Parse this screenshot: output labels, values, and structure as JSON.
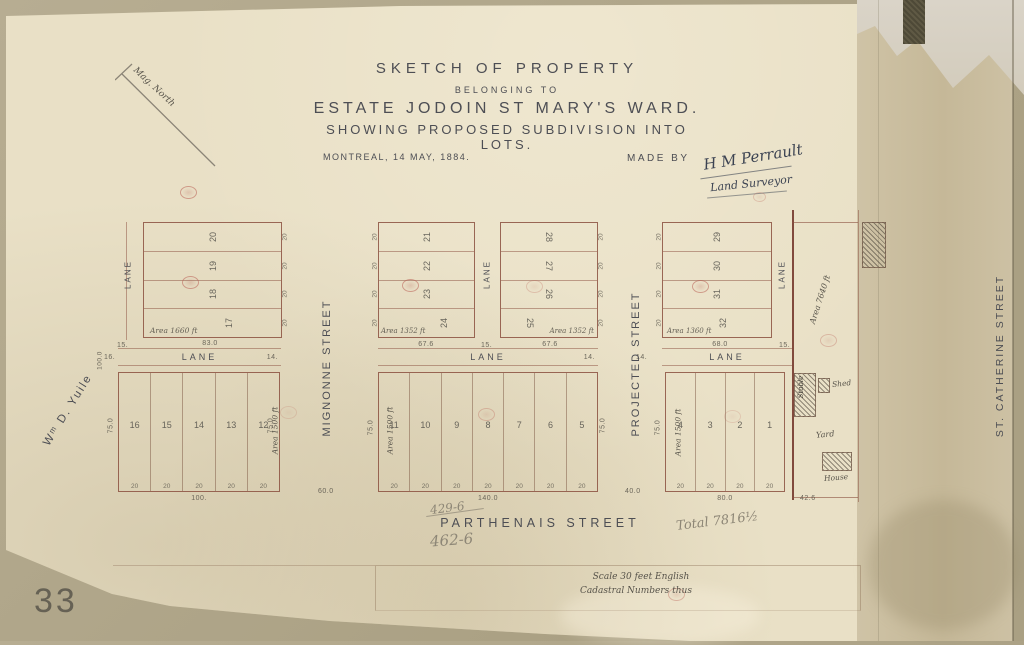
{
  "palette": {
    "backing": "#b2a88c",
    "sheet": "#e9e0c6",
    "stained_strip": "#c9bc9e",
    "ink": "#4d4e54",
    "plan_line": "#8b4d3e",
    "stamp_red": "#ba6156",
    "pencil": "#8d8676"
  },
  "header": {
    "title1": "SKETCH OF PROPERTY",
    "title2": "BELONGING TO",
    "title3": "ESTATE JODOIN ST MARY'S WARD.",
    "title4": "SHOWING PROPOSED SUBDIVISION INTO LOTS.",
    "date": "MONTREAL, 14 MAY, 1884.",
    "made_by": "MADE BY",
    "signature": "H M Perrault",
    "signature_role": "Land Surveyor"
  },
  "north": {
    "label": "Mag. North"
  },
  "streets": {
    "owner_left": "Wᵐ D. Yuile",
    "mignonne": "MIGNONNE STREET",
    "projected": "PROJECTED STREET",
    "st_catherine": "ST. CATHERINE STREET",
    "parthenais": "PARTHENAIS STREET",
    "lane": "LANE",
    "mignonne_width": "60.0",
    "projected_width": "40.0"
  },
  "top_blocks": {
    "a": {
      "lots": [
        "20",
        "19",
        "18",
        "17"
      ],
      "tick": "20",
      "area_note": "Area 1660 ft",
      "frontage": "83.0"
    },
    "b": {
      "lots": [
        "21",
        "22",
        "23",
        "24"
      ],
      "tick": "20",
      "area_note": "Area 1352 ft",
      "frontage": "67.6"
    },
    "c": {
      "lots": [
        "28",
        "27",
        "26",
        "25"
      ],
      "tick": "20",
      "area_note": "Area 1352 ft",
      "frontage": "67.6"
    },
    "d": {
      "lots": [
        "29",
        "30",
        "31",
        "32"
      ],
      "tick": "20",
      "area_note": "Area 1360 ft",
      "frontage": "68.0"
    }
  },
  "bottom_blocks": {
    "left": {
      "lots": [
        "16",
        "15",
        "14",
        "13",
        "12"
      ],
      "width_tick": "20",
      "total": "100.",
      "depth": "75.0",
      "area_note": "Area 1500 ft"
    },
    "middle": {
      "lots": [
        "11",
        "10",
        "9",
        "8",
        "7",
        "6",
        "5"
      ],
      "width_tick": "20",
      "total": "140.0",
      "depth": "75.0",
      "area_note": "Area 1500 ft"
    },
    "right": {
      "lots": [
        "4",
        "3",
        "2",
        "1"
      ],
      "width_tick": "20",
      "total": "80.0",
      "depth": "75.0",
      "area_note": "Area 1500 ft"
    }
  },
  "lane_ticks": {
    "v_left": "15.",
    "v_mid": "15.",
    "v_right": "15.",
    "h_left_start": "16.",
    "h_left_end": "14.",
    "h_mid_end": "14.",
    "h_right_start": "14."
  },
  "yuile_dim": "100.0",
  "homestead": {
    "area_note": "Area 7640 ft",
    "stable": "Stable",
    "shed": "Shed",
    "yard": "Yard",
    "house": "House",
    "frontage": "42.6"
  },
  "pencil": {
    "calc1": "429-6",
    "calc2": "462-6",
    "total": "Total 7816½"
  },
  "scale": {
    "line1": "Scale 30 feet English",
    "line2": "Cadastral Numbers thus"
  },
  "corner_number": "33"
}
